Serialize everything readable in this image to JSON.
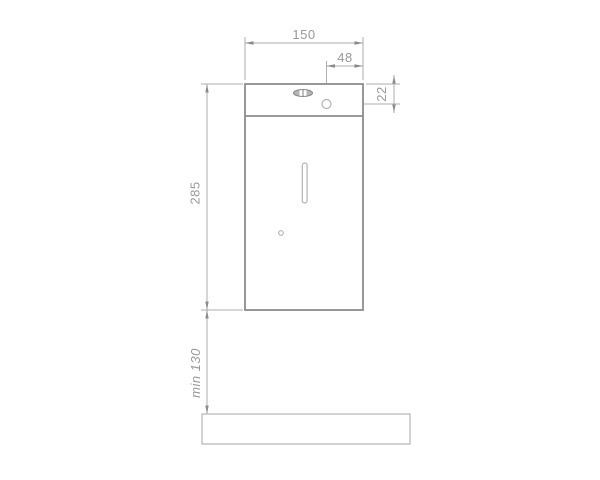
{
  "drawing": {
    "dimension_labels": {
      "body_width": "150",
      "hole_offset_horizontal": "48",
      "hole_offset_vertical": "22",
      "body_height": "285",
      "clearance_below": "min 130"
    },
    "colors": {
      "background": "#ffffff",
      "body_outline": "#8d8d8d",
      "dimension_line": "#aeaeae",
      "feature_line": "#b3b3b3",
      "arrow": "#8a8a8a",
      "label_text": "#999999"
    }
  }
}
